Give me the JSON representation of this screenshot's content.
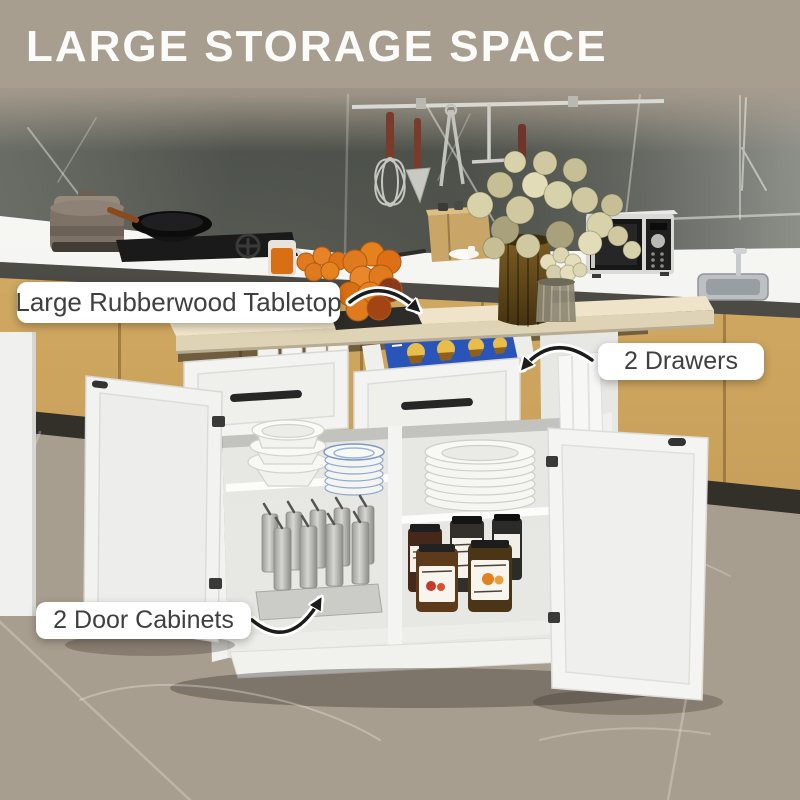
{
  "title": "LARGE STORAGE SPACE",
  "callouts": {
    "tabletop": "Large Rubberwood Tabletop",
    "drawers": "2 Drawers",
    "cabinets": "2 Door Cabinets"
  },
  "colors": {
    "banner_bg": "#a89e8f",
    "title_text": "#fbfbf9",
    "pill_bg": "#ffffff",
    "pill_text": "#3f3f3f",
    "arrow": "#1c1c1c",
    "island_white": "#f3f3f1",
    "tabletop_wood": "#ece1c4",
    "base_cabinet_wood": "#cda55f",
    "backsplash_marble": "#53574f",
    "floor_marble": "#7c756c",
    "package_blue": "#2a55b8",
    "orange_fruit": "#e07a1e"
  }
}
